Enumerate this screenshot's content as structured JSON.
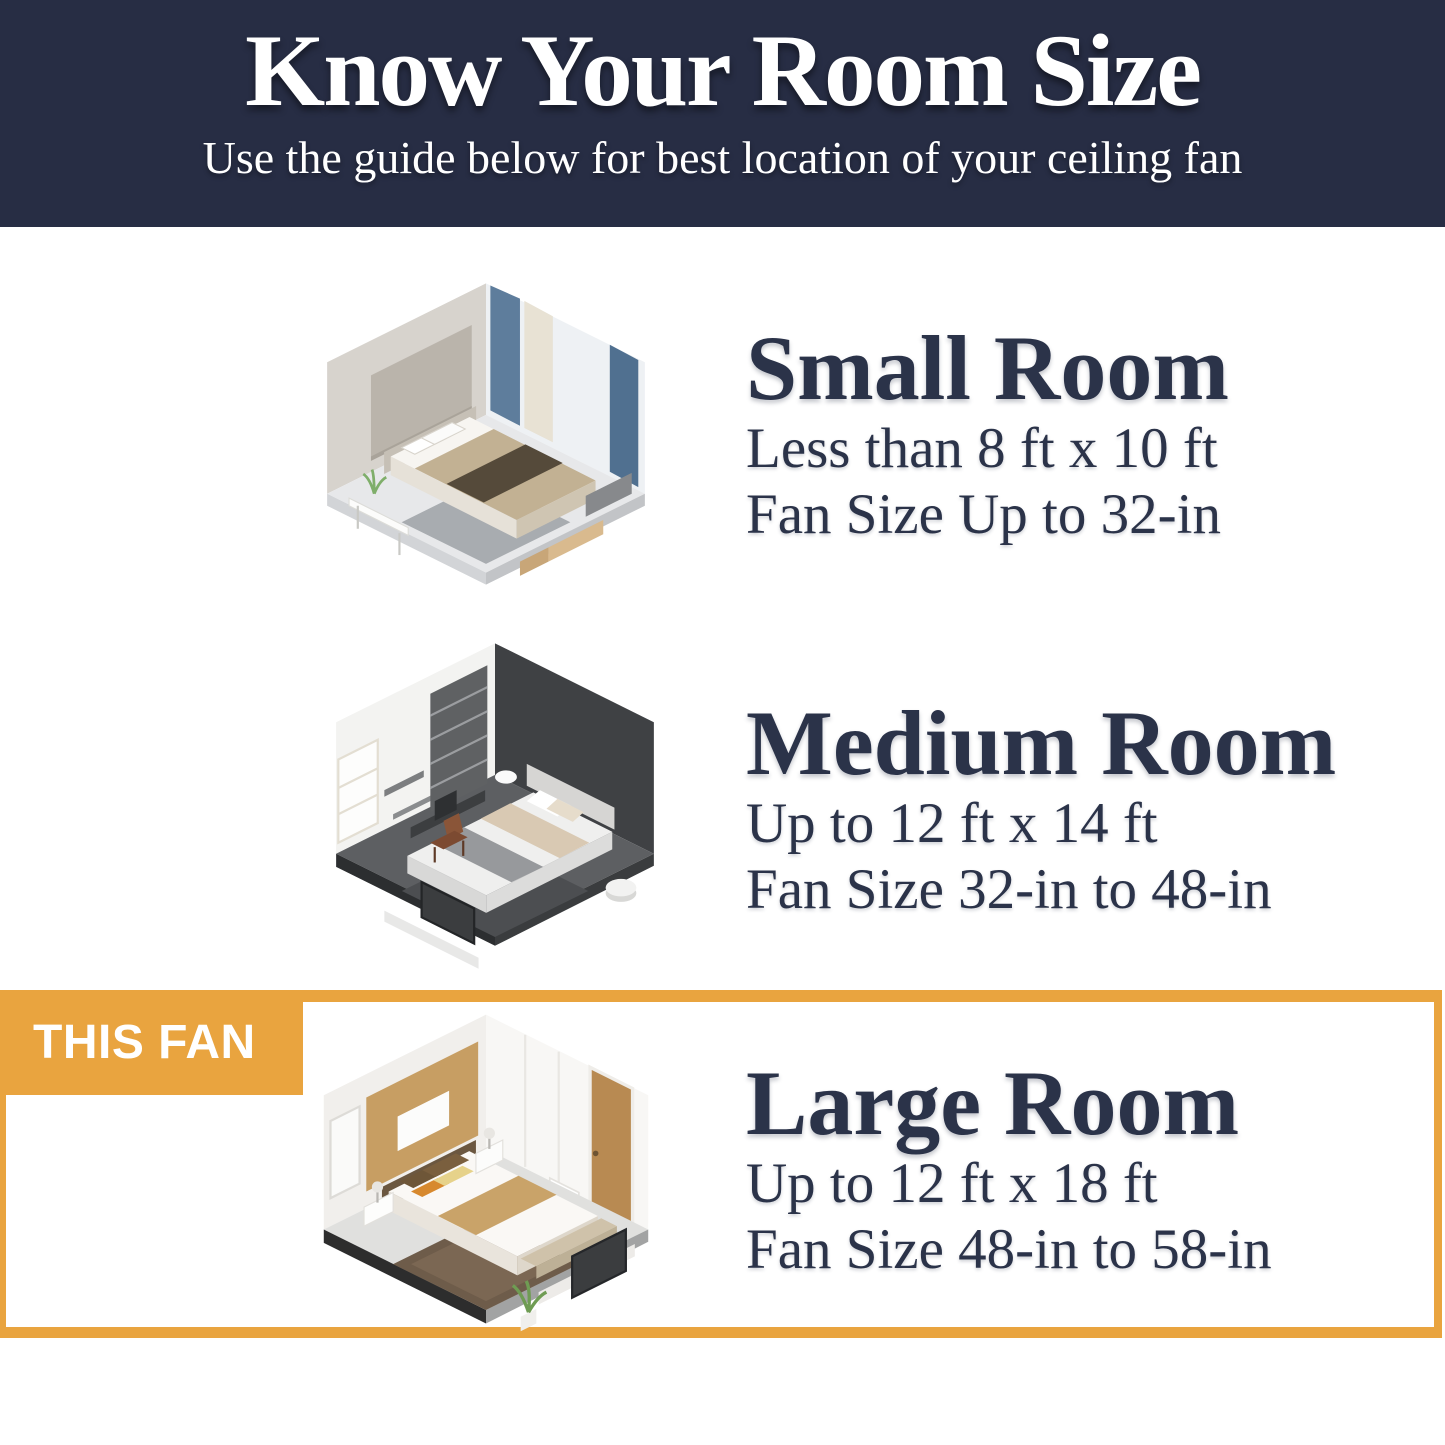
{
  "header": {
    "title": "Know Your Room Size",
    "subtitle": "Use the guide below for best location of your ceiling fan",
    "background_color": "#272d44",
    "text_color": "#ffffff"
  },
  "highlight": {
    "badge_label": "THIS FAN",
    "accent_color": "#e9a43f"
  },
  "body_text_color": "#2b3349",
  "sections": [
    {
      "title": "Small Room",
      "size_line": "Less than 8 ft x 10 ft",
      "fan_line": "Fan Size Up to 32-in",
      "illustration": "small-bedroom-isometric",
      "highlighted": false
    },
    {
      "title": "Medium Room",
      "size_line": "Up to 12 ft x 14 ft",
      "fan_line": "Fan Size 32-in to 48-in",
      "illustration": "medium-bedroom-isometric",
      "highlighted": false
    },
    {
      "title": "Large Room",
      "size_line": "Up to 12 ft x 18 ft",
      "fan_line": "Fan Size 48-in to 58-in",
      "illustration": "large-bedroom-isometric",
      "highlighted": true
    }
  ]
}
